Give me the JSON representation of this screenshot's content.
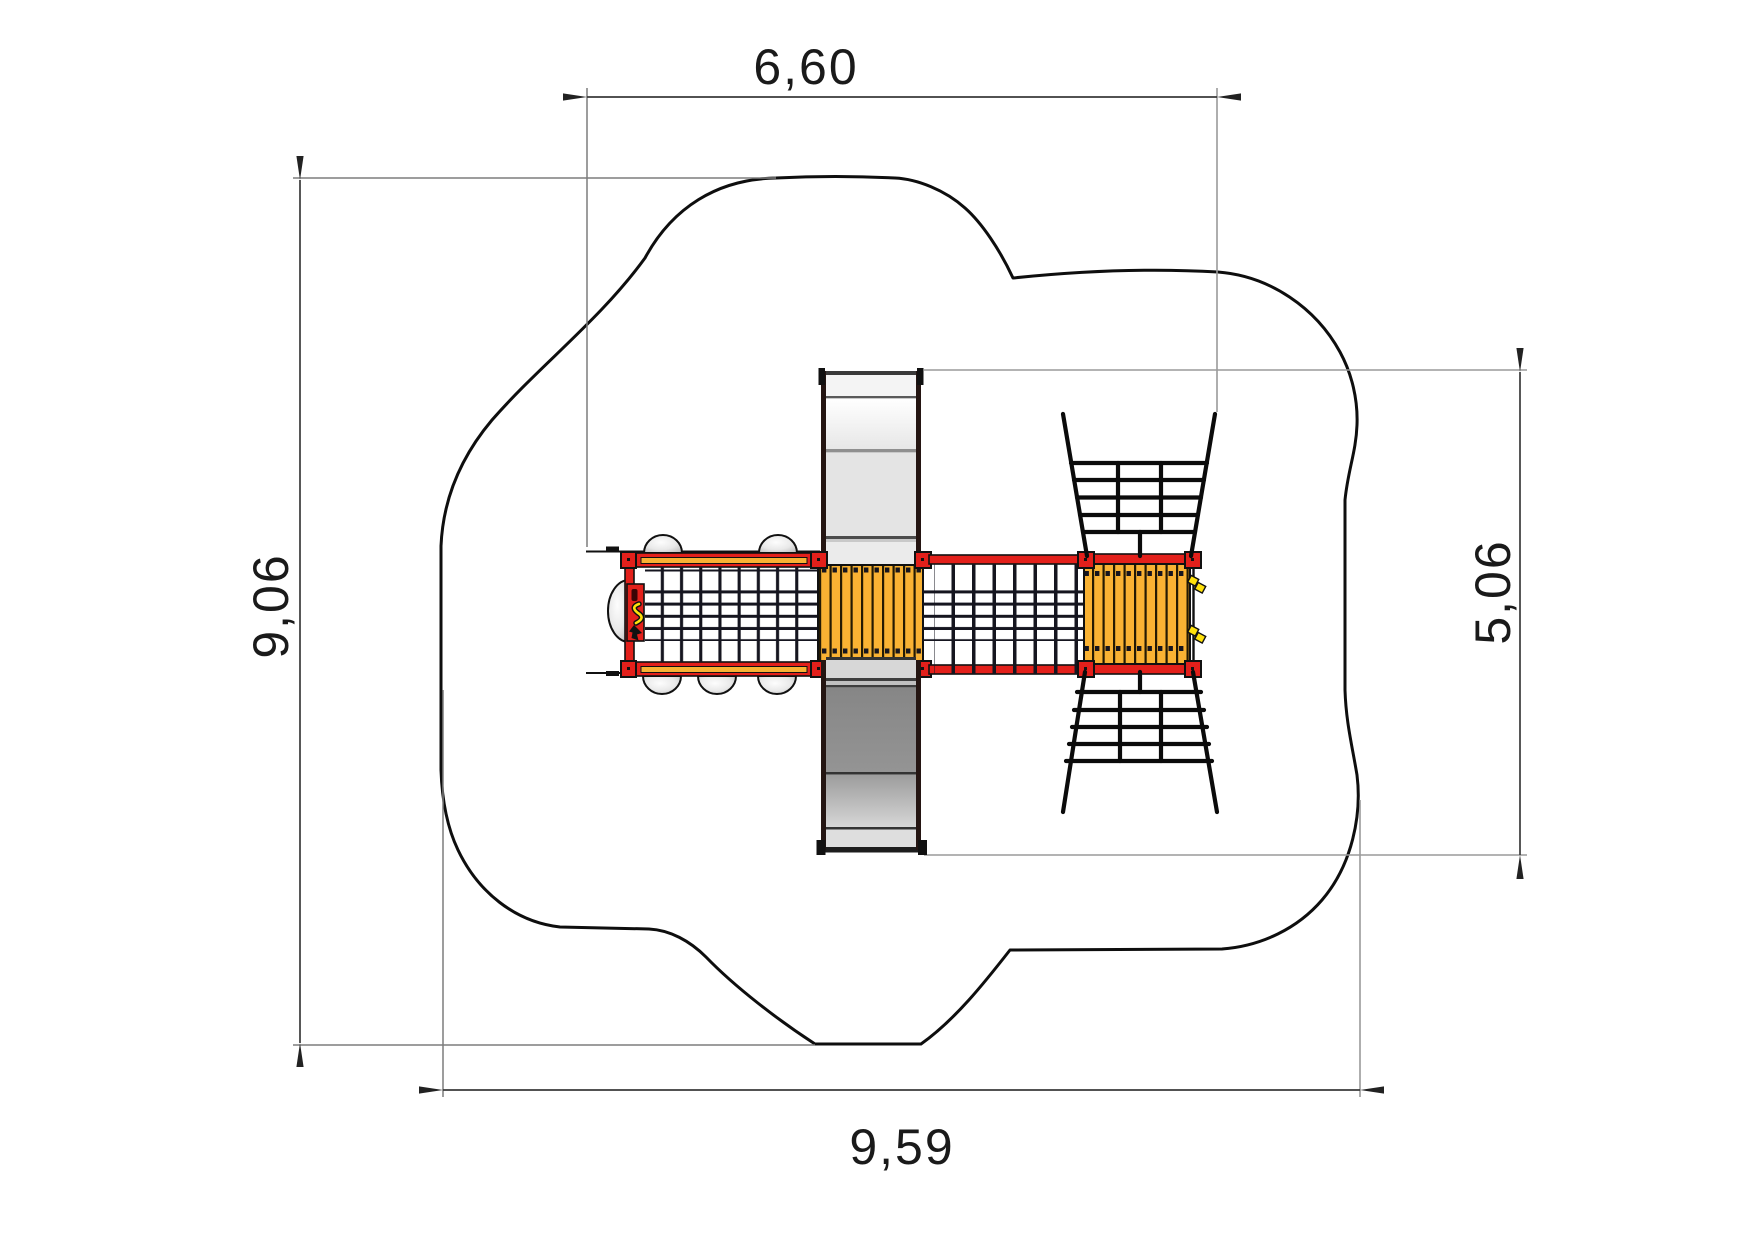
{
  "drawing": {
    "dimension_labels": {
      "top": "6,60",
      "left": "9,06",
      "right": "5,06",
      "bottom": "9,59"
    }
  },
  "colors": {
    "frame-red": "#e3201b",
    "deck-orange": "#f9b233",
    "hardware-yellow": "#ffe10a",
    "slide-light": "#e6e6e6",
    "slide-dark": "#8f8f8f",
    "net-dark": "#15151f",
    "outline-black": "#0e0e0e",
    "dim-line": "#3a3a3a",
    "ext-line": "#7d7d7d",
    "text-color": "#1a1a1a"
  }
}
